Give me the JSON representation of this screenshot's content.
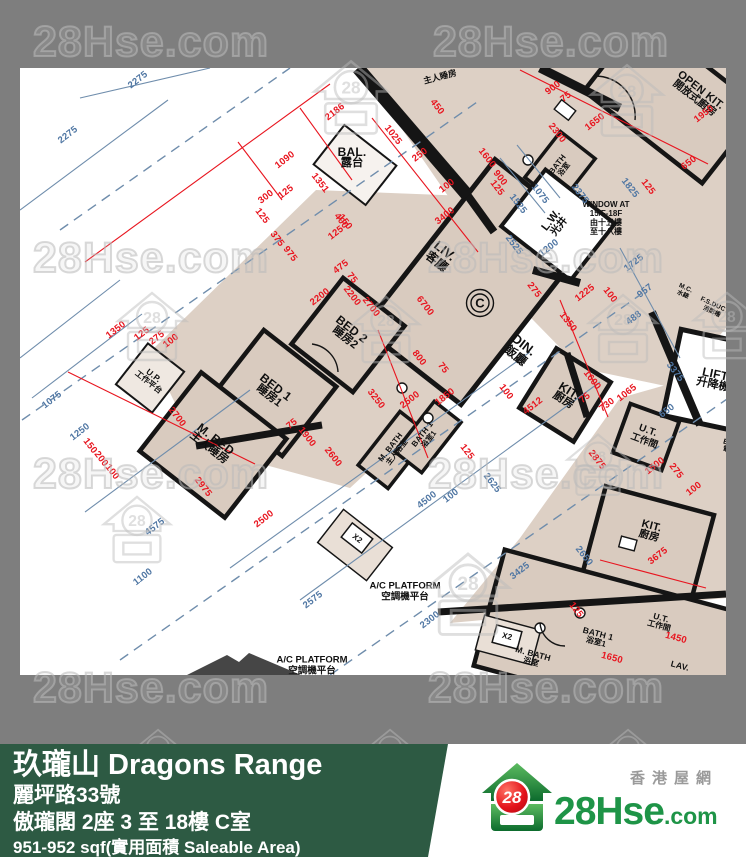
{
  "watermark": {
    "text": "28Hse.com",
    "logo_number": "28",
    "text_positions": [
      {
        "x": 33,
        "y": 18
      },
      {
        "x": 433,
        "y": 18
      },
      {
        "x": 33,
        "y": 234
      },
      {
        "x": 428,
        "y": 234
      },
      {
        "x": 33,
        "y": 450
      },
      {
        "x": 428,
        "y": 450
      },
      {
        "x": 33,
        "y": 664
      },
      {
        "x": 428,
        "y": 664
      }
    ],
    "logo_positions": [
      {
        "x": 308,
        "y": 56,
        "s": 86
      },
      {
        "x": 585,
        "y": 60,
        "s": 84
      },
      {
        "x": 112,
        "y": 288,
        "s": 80
      },
      {
        "x": 347,
        "y": 292,
        "s": 78
      },
      {
        "x": 583,
        "y": 290,
        "s": 80
      },
      {
        "x": 688,
        "y": 288,
        "s": 78
      },
      {
        "x": 98,
        "y": 492,
        "s": 78
      },
      {
        "x": 420,
        "y": 548,
        "s": 96
      },
      {
        "x": 562,
        "y": 430,
        "s": 72
      },
      {
        "x": 128,
        "y": 726,
        "s": 60
      },
      {
        "x": 360,
        "y": 726,
        "s": 60
      },
      {
        "x": 598,
        "y": 726,
        "s": 60
      }
    ]
  },
  "plan": {
    "unit_marker": {
      "label": "C",
      "x": 480,
      "y": 303
    },
    "rooms": [
      {
        "id": "bal",
        "en": "BAL.",
        "zh": "露台",
        "x": 352,
        "y": 158,
        "a": 0,
        "fs": 12
      },
      {
        "id": "liv",
        "en": "LIV.",
        "zh": "客廳",
        "x": 441,
        "y": 256,
        "a": 38,
        "fs": 13
      },
      {
        "id": "din",
        "en": "DIN.",
        "zh": "飯廳",
        "x": 520,
        "y": 350,
        "a": 38,
        "fs": 13
      },
      {
        "id": "bed2",
        "en": "BED 2",
        "zh": "睡房2",
        "x": 348,
        "y": 334,
        "a": 38,
        "fs": 12
      },
      {
        "id": "bed1",
        "en": "BED 1",
        "zh": "睡房1",
        "x": 272,
        "y": 392,
        "a": 38,
        "fs": 12
      },
      {
        "id": "mbed",
        "en": "M. BED",
        "zh": "主人睡房",
        "x": 212,
        "y": 444,
        "a": 38,
        "fs": 12
      },
      {
        "id": "up",
        "en": "U.P.",
        "zh": "工作平台",
        "x": 151,
        "y": 379,
        "a": 38,
        "fs": 8.5
      },
      {
        "id": "mbath",
        "en": "M. BATH",
        "zh": "主人浴室",
        "x": 394,
        "y": 450,
        "a": -52,
        "fs": 8
      },
      {
        "id": "bath1",
        "en": "BATH 1",
        "zh": "浴室1",
        "x": 426,
        "y": 437,
        "a": -52,
        "fs": 8
      },
      {
        "id": "kit",
        "en": "KIT.",
        "zh": "廚房",
        "x": 566,
        "y": 396,
        "a": 32,
        "fs": 12
      },
      {
        "id": "ut",
        "en": "U.T.",
        "zh": "工作間",
        "x": 646,
        "y": 436,
        "a": 20,
        "fs": 10
      },
      {
        "id": "lw",
        "en": "L.W.",
        "zh": "光井",
        "x": 556,
        "y": 224,
        "a": -52,
        "fs": 11
      },
      {
        "id": "openkit",
        "en": "OPEN KIT.",
        "zh": "開放式廚房",
        "x": 697,
        "y": 95,
        "a": 38,
        "fs": 11
      },
      {
        "id": "bath-adj",
        "en": "BATH",
        "zh": "浴室",
        "x": 561,
        "y": 167,
        "a": -52,
        "fs": 8
      },
      {
        "id": "mbed-adj",
        "en": "",
        "zh": "主人睡房",
        "x": 440,
        "y": 77,
        "a": -15,
        "fs": 9
      },
      {
        "id": "lift",
        "en": "LIFT",
        "zh": "升降機",
        "x": 714,
        "y": 380,
        "a": 12,
        "fs": 12
      },
      {
        "id": "mc",
        "en": "M.C.",
        "zh": "水錶",
        "x": 684,
        "y": 292,
        "a": 25,
        "fs": 6.5
      },
      {
        "id": "fsduct",
        "en": "F.S.DUCT",
        "zh": "消防槽",
        "x": 713,
        "y": 309,
        "a": 25,
        "fs": 6.5
      },
      {
        "id": "emc",
        "en": "E.M.C.",
        "zh": "電錶房",
        "x": 734,
        "y": 448,
        "a": 15,
        "fs": 7.5
      },
      {
        "id": "kit2",
        "en": "KIT.",
        "zh": "廚房",
        "x": 650,
        "y": 532,
        "a": 15,
        "fs": 11
      },
      {
        "id": "mbath2",
        "en": "M. BATH",
        "zh": "浴室",
        "x": 532,
        "y": 658,
        "a": 15,
        "fs": 8.5
      },
      {
        "id": "bath1-2",
        "en": "BATH 1",
        "zh": "浴室1",
        "x": 597,
        "y": 638,
        "a": 15,
        "fs": 8.5
      },
      {
        "id": "ut2",
        "en": "U.T.",
        "zh": "工作間",
        "x": 660,
        "y": 622,
        "a": 15,
        "fs": 8.5
      },
      {
        "id": "lav2",
        "en": "LAV.",
        "zh": "",
        "x": 680,
        "y": 666,
        "a": 15,
        "fs": 8.5
      },
      {
        "id": "x2a",
        "en": "X2",
        "zh": "",
        "x": 357,
        "y": 539,
        "a": 38,
        "fs": 8
      },
      {
        "id": "x2b",
        "en": "X2",
        "zh": "",
        "x": 507,
        "y": 637,
        "a": 15,
        "fs": 8
      }
    ],
    "annotations": [
      {
        "id": "window-note",
        "lines": [
          "WINDOW AT",
          "15/F-18F",
          "由十五樓",
          "至十八樓"
        ],
        "x": 606,
        "y": 219,
        "fs": 8
      },
      {
        "id": "acp1",
        "lines": [
          "A/C PLATFORM",
          "空調機平台"
        ],
        "x": 405,
        "y": 592,
        "fs": 9.5
      },
      {
        "id": "acp2",
        "lines": [
          "A/C PLATFORM",
          "空調機平台"
        ],
        "x": 312,
        "y": 666,
        "fs": 9.5
      }
    ],
    "dims_red": [
      {
        "t": "2186",
        "x": 335,
        "y": 112,
        "a": -38
      },
      {
        "t": "1090",
        "x": 285,
        "y": 160,
        "a": -38
      },
      {
        "t": "1025",
        "x": 393,
        "y": 135,
        "a": 52
      },
      {
        "t": "450",
        "x": 437,
        "y": 107,
        "a": 52
      },
      {
        "t": "250",
        "x": 420,
        "y": 155,
        "a": -38
      },
      {
        "t": "300",
        "x": 266,
        "y": 197,
        "a": -38
      },
      {
        "t": "125",
        "x": 286,
        "y": 192,
        "a": -38
      },
      {
        "t": "1351",
        "x": 320,
        "y": 183,
        "a": 52
      },
      {
        "t": "400",
        "x": 341,
        "y": 221,
        "a": 52
      },
      {
        "t": "150",
        "x": 345,
        "y": 222,
        "a": 52
      },
      {
        "t": "125",
        "x": 336,
        "y": 233,
        "a": -38
      },
      {
        "t": "375",
        "x": 277,
        "y": 239,
        "a": 52
      },
      {
        "t": "975",
        "x": 290,
        "y": 254,
        "a": 52
      },
      {
        "t": "125",
        "x": 262,
        "y": 216,
        "a": 52
      },
      {
        "t": "475",
        "x": 341,
        "y": 267,
        "a": -38
      },
      {
        "t": "75",
        "x": 352,
        "y": 278,
        "a": 52
      },
      {
        "t": "2200",
        "x": 352,
        "y": 296,
        "a": 52
      },
      {
        "t": "100",
        "x": 447,
        "y": 186,
        "a": -38
      },
      {
        "t": "3400",
        "x": 445,
        "y": 216,
        "a": -38
      },
      {
        "t": "1600",
        "x": 487,
        "y": 158,
        "a": 52
      },
      {
        "t": "900",
        "x": 500,
        "y": 178,
        "a": 52
      },
      {
        "t": "125",
        "x": 497,
        "y": 188,
        "a": 52
      },
      {
        "t": "6700",
        "x": 425,
        "y": 306,
        "a": 52
      },
      {
        "t": "800",
        "x": 419,
        "y": 358,
        "a": 52
      },
      {
        "t": "75",
        "x": 443,
        "y": 368,
        "a": 52
      },
      {
        "t": "2200",
        "x": 320,
        "y": 297,
        "a": -38
      },
      {
        "t": "2700",
        "x": 371,
        "y": 307,
        "a": 52
      },
      {
        "t": "3250",
        "x": 376,
        "y": 399,
        "a": 52
      },
      {
        "t": "1900",
        "x": 307,
        "y": 437,
        "a": 52
      },
      {
        "t": "2600",
        "x": 333,
        "y": 457,
        "a": 52
      },
      {
        "t": "75",
        "x": 292,
        "y": 424,
        "a": -38
      },
      {
        "t": "2700",
        "x": 177,
        "y": 417,
        "a": 52
      },
      {
        "t": "2975",
        "x": 203,
        "y": 487,
        "a": 52
      },
      {
        "t": "2500",
        "x": 264,
        "y": 519,
        "a": -38
      },
      {
        "t": "1350",
        "x": 116,
        "y": 330,
        "a": -38
      },
      {
        "t": "125",
        "x": 142,
        "y": 334,
        "a": -38
      },
      {
        "t": "275",
        "x": 157,
        "y": 338,
        "a": -38
      },
      {
        "t": "100",
        "x": 171,
        "y": 341,
        "a": -38
      },
      {
        "t": "150",
        "x": 90,
        "y": 446,
        "a": 52
      },
      {
        "t": "200",
        "x": 101,
        "y": 459,
        "a": 52
      },
      {
        "t": "100",
        "x": 112,
        "y": 472,
        "a": 52
      },
      {
        "t": "2300",
        "x": 557,
        "y": 133,
        "a": 52
      },
      {
        "t": "900",
        "x": 553,
        "y": 88,
        "a": -38
      },
      {
        "t": "75",
        "x": 566,
        "y": 97,
        "a": -38
      },
      {
        "t": "1650",
        "x": 595,
        "y": 122,
        "a": -38
      },
      {
        "t": "1950",
        "x": 704,
        "y": 114,
        "a": -38
      },
      {
        "t": "650",
        "x": 689,
        "y": 163,
        "a": -38
      },
      {
        "t": "125",
        "x": 648,
        "y": 187,
        "a": 52
      },
      {
        "t": "275",
        "x": 534,
        "y": 290,
        "a": 52
      },
      {
        "t": "1350",
        "x": 568,
        "y": 322,
        "a": 52
      },
      {
        "t": "1225",
        "x": 585,
        "y": 293,
        "a": -38
      },
      {
        "t": "100",
        "x": 610,
        "y": 295,
        "a": 52
      },
      {
        "t": "1600",
        "x": 592,
        "y": 380,
        "a": 52
      },
      {
        "t": "1065",
        "x": 627,
        "y": 393,
        "a": -38
      },
      {
        "t": "730",
        "x": 607,
        "y": 405,
        "a": -38
      },
      {
        "t": "75",
        "x": 585,
        "y": 398,
        "a": -38
      },
      {
        "t": "2875",
        "x": 597,
        "y": 460,
        "a": 52
      },
      {
        "t": "1500",
        "x": 655,
        "y": 466,
        "a": -38
      },
      {
        "t": "275",
        "x": 676,
        "y": 471,
        "a": 52
      },
      {
        "t": "100",
        "x": 694,
        "y": 489,
        "a": -38
      },
      {
        "t": "4512",
        "x": 533,
        "y": 406,
        "a": -38
      },
      {
        "t": "2500",
        "x": 410,
        "y": 400,
        "a": -38
      },
      {
        "t": "1850",
        "x": 445,
        "y": 397,
        "a": -38
      },
      {
        "t": "125",
        "x": 467,
        "y": 452,
        "a": 52
      },
      {
        "t": "100",
        "x": 506,
        "y": 392,
        "a": 52
      },
      {
        "t": "3675",
        "x": 658,
        "y": 556,
        "a": -38
      },
      {
        "t": "1450",
        "x": 676,
        "y": 638,
        "a": 15
      },
      {
        "t": "1650",
        "x": 612,
        "y": 658,
        "a": 15
      },
      {
        "t": "125",
        "x": 576,
        "y": 610,
        "a": 52
      }
    ],
    "dims_blue": [
      {
        "t": "2275",
        "x": 68,
        "y": 135,
        "a": -38
      },
      {
        "t": "2275",
        "x": 138,
        "y": 80,
        "a": -38
      },
      {
        "t": "1075",
        "x": 52,
        "y": 400,
        "a": -38
      },
      {
        "t": "1250",
        "x": 80,
        "y": 432,
        "a": -38
      },
      {
        "t": "4575",
        "x": 155,
        "y": 527,
        "a": -38
      },
      {
        "t": "1100",
        "x": 143,
        "y": 577,
        "a": -38
      },
      {
        "t": "2575",
        "x": 313,
        "y": 600,
        "a": -38
      },
      {
        "t": "4500",
        "x": 427,
        "y": 500,
        "a": -38
      },
      {
        "t": "2300",
        "x": 430,
        "y": 620,
        "a": -38
      },
      {
        "t": "3425",
        "x": 520,
        "y": 571,
        "a": -38
      },
      {
        "t": "1525",
        "x": 518,
        "y": 204,
        "a": 52
      },
      {
        "t": "1075",
        "x": 540,
        "y": 194,
        "a": 52
      },
      {
        "t": "2525",
        "x": 514,
        "y": 245,
        "a": 52
      },
      {
        "t": "2375",
        "x": 580,
        "y": 194,
        "a": 52
      },
      {
        "t": "1825",
        "x": 630,
        "y": 188,
        "a": 52
      },
      {
        "t": "1200",
        "x": 549,
        "y": 248,
        "a": -38
      },
      {
        "t": "1725",
        "x": 634,
        "y": 263,
        "a": -38
      },
      {
        "t": "957",
        "x": 645,
        "y": 291,
        "a": -38
      },
      {
        "t": "488",
        "x": 634,
        "y": 318,
        "a": -38
      },
      {
        "t": "3375",
        "x": 675,
        "y": 372,
        "a": 52
      },
      {
        "t": "650",
        "x": 667,
        "y": 411,
        "a": -38
      },
      {
        "t": "2650",
        "x": 584,
        "y": 556,
        "a": 52
      },
      {
        "t": "2625",
        "x": 492,
        "y": 483,
        "a": 52
      },
      {
        "t": "100",
        "x": 451,
        "y": 496,
        "a": -38
      }
    ]
  },
  "footer": {
    "title": "玖瓏山 Dragons Range",
    "address": "麗坪路33號",
    "unit": "傲瓏閣 2座 3 至 18樓 C室",
    "area": "951-952 sqf(實用面積 Saleable Area)",
    "brand": {
      "name_main": "28Hse",
      "name_suffix": ".com",
      "tagline": "香港屋網",
      "logo_number": "28"
    }
  },
  "colors": {
    "dim_red": "#e8151f",
    "dim_blue": "#4f76a3",
    "floor_beige": "#ddd0c5",
    "wall_black": "#151515",
    "band_gray": "#7e7e7e",
    "footer_green": "#2d5a43",
    "brand_green": "#1e9447"
  }
}
